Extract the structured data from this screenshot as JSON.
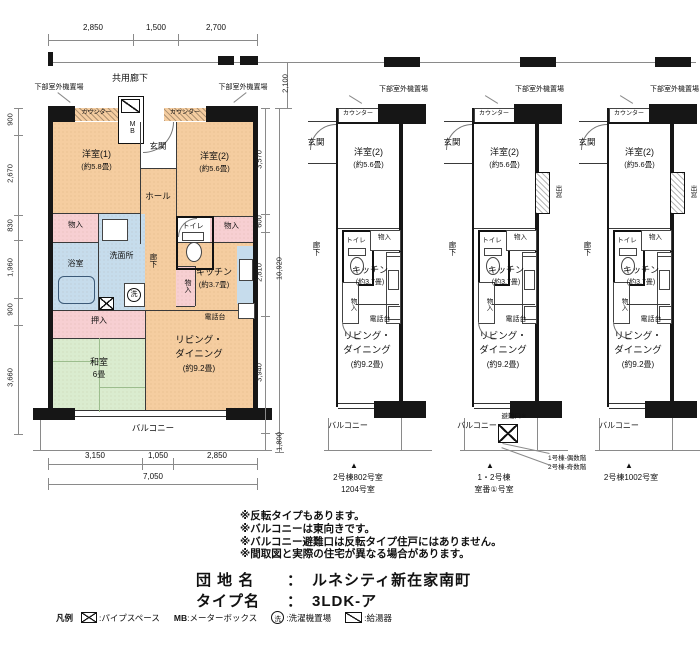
{
  "top": {
    "dims": [
      "2,850",
      "1,500",
      "2,700"
    ],
    "corridor_label": "共用廊下",
    "corridor_depth_dim": "2,100"
  },
  "plan1": {
    "outdoor_left": "下部室外機置場",
    "outdoor_right": "下部室外機置場",
    "counter_left": "カウンター",
    "counter_right": "カウンター",
    "mb": "MB",
    "genkan": "玄関",
    "room1_name": "洋室(1)",
    "room1_size": "(約5.8畳)",
    "room2_name": "洋室(2)",
    "room2_size": "(約5.6畳)",
    "hall": "ホール",
    "closet_left": "物入",
    "washroom": "洗面所",
    "wash_mark": "洗",
    "bath": "浴室",
    "corridor": "廊下",
    "toilet": "トイレ",
    "closet_right": "物入",
    "closet_kitchen": "物入",
    "kitchen_name": "キッチン",
    "kitchen_size": "(約3.7畳)",
    "oshiire": "押入",
    "phone": "電話台",
    "washitsu_name": "和室",
    "washitsu_size": "6畳",
    "living_line1": "リビング・",
    "living_line2": "ダイニング",
    "living_size": "(約9.2畳)",
    "balcony": "バルコニー",
    "dims_left": [
      "900",
      "2,670",
      "830",
      "1,960",
      "900",
      "3,660"
    ],
    "dims_right": [
      "3,570",
      "600",
      "2,810",
      "3,940"
    ],
    "dim_right_total": "10,920",
    "dim_balcony_depth": "1,800",
    "dims_bottom": [
      "3,150",
      "1,050",
      "2,850"
    ],
    "dim_bottom_total": "7,050"
  },
  "plans": [
    {
      "outdoor": "下部室外機置場",
      "counter": "カウンター",
      "genkan": "玄関",
      "room_name": "洋室(2)",
      "room_size": "(約5.6畳)",
      "toilet": "トイレ",
      "closet": "物入",
      "corridor": "廊下",
      "closet2": "物入",
      "kitchen_name": "キッチン",
      "kitchen_size": "(約3.7畳)",
      "phone": "電話台",
      "living_line1": "リビング・",
      "living_line2": "ダイニング",
      "living_size": "(約9.2畳)",
      "balcony": "バルコニー",
      "marker": "▲",
      "caption1": "2号棟802号室",
      "caption2": "1204号室"
    },
    {
      "outdoor": "下部室外機置場",
      "counter": "カウンター",
      "genkan": "玄関",
      "room_name": "洋室(2)",
      "room_size": "(約5.6畳)",
      "toilet": "トイレ",
      "closet": "物入",
      "corridor": "廊下",
      "closet2": "物入",
      "kitchen_name": "キッチン",
      "kitchen_size": "(約3.7畳)",
      "phone": "電話台",
      "living_line1": "リビング・",
      "living_line2": "ダイニング",
      "living_size": "(約9.2畳)",
      "balcony": "バルコニー",
      "marker": "▲",
      "bay": "出窓",
      "hatch": "避難口※",
      "caption1": "1・2号棟",
      "caption2": "室番①号室"
    },
    {
      "outdoor": "下部室外機置場",
      "counter": "カウンター",
      "genkan": "玄関",
      "room_name": "洋室(2)",
      "room_size": "(約5.6畳)",
      "toilet": "トイレ",
      "closet": "物入",
      "corridor": "廊下",
      "closet2": "物入",
      "kitchen_name": "キッチン",
      "kitchen_size": "(約3.7畳)",
      "phone": "電話台",
      "living_line1": "リビング・",
      "living_line2": "ダイニング",
      "living_size": "(約9.2畳)",
      "balcony": "バルコニー",
      "marker": "▲",
      "bay": "出窓",
      "caption1": "2号棟1002号室",
      "caption2": ""
    }
  ],
  "hatch_notes": [
    "1号棟-偶数階",
    "2号棟-奇数階"
  ],
  "notes": [
    "※反転タイプもあります。",
    "※バルコニーは東向きです。",
    "※バルコニー避難口は反転タイプ住戸にはありません。",
    "※間取図と実際の住宅が異なる場合があります。"
  ],
  "title": {
    "row1_label": "団 地 名",
    "row1_sep": "：",
    "row1_value": "ルネシティ新在家南町",
    "row2_label": "タイプ名",
    "row2_sep": "：",
    "row2_value": "3LDK-ア"
  },
  "legend": {
    "label": "凡例",
    "pipe_text": ":パイプスペース",
    "mb_sym": "MB",
    "mb_text": ":メーターボックス",
    "wash_sym": "洗",
    "wash_text": ":洗濯機置場",
    "heater_text": ":給湯器"
  }
}
